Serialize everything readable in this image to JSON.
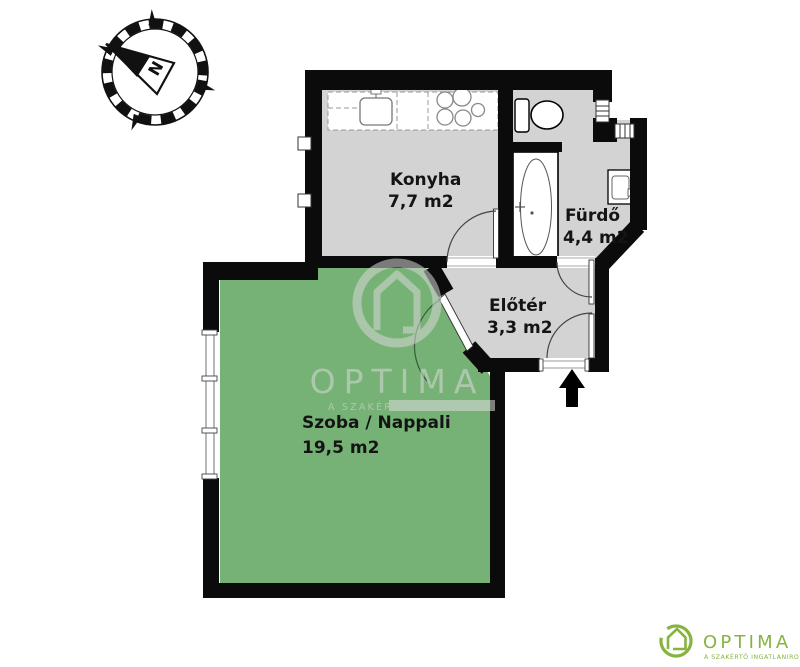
{
  "compass": {
    "north_label": "N"
  },
  "rooms": [
    {
      "name": "Konyha",
      "area": "7,7 m2",
      "floor_color": "#d3d3d3"
    },
    {
      "name": "Fürdő",
      "area": "4,4 m2",
      "floor_color": "#d3d3d3"
    },
    {
      "name": "Előtér",
      "area": "3,3 m2",
      "floor_color": "#d3d3d3"
    },
    {
      "name": "Szoba / Nappali",
      "area": "19,5 m2",
      "floor_color": "#76b275"
    }
  ],
  "fixtures": [
    "kitchen-counter",
    "sink",
    "stove",
    "toilet",
    "bathtub",
    "washbasin",
    "entry-arrow"
  ],
  "watermark": {
    "brand": "OPTIMA",
    "tagline": "A SZAKÉRTŐ"
  },
  "logo": {
    "brand": "OPTIMA",
    "tagline": "A SZAKÉRTŐ INGATLANIRODA"
  },
  "colors": {
    "wall": "#0b0b0b",
    "floor_gray": "#d3d3d3",
    "floor_green": "#76b275",
    "watermark_gray": "#d9d9d9",
    "logo_green": "#86b43f"
  }
}
